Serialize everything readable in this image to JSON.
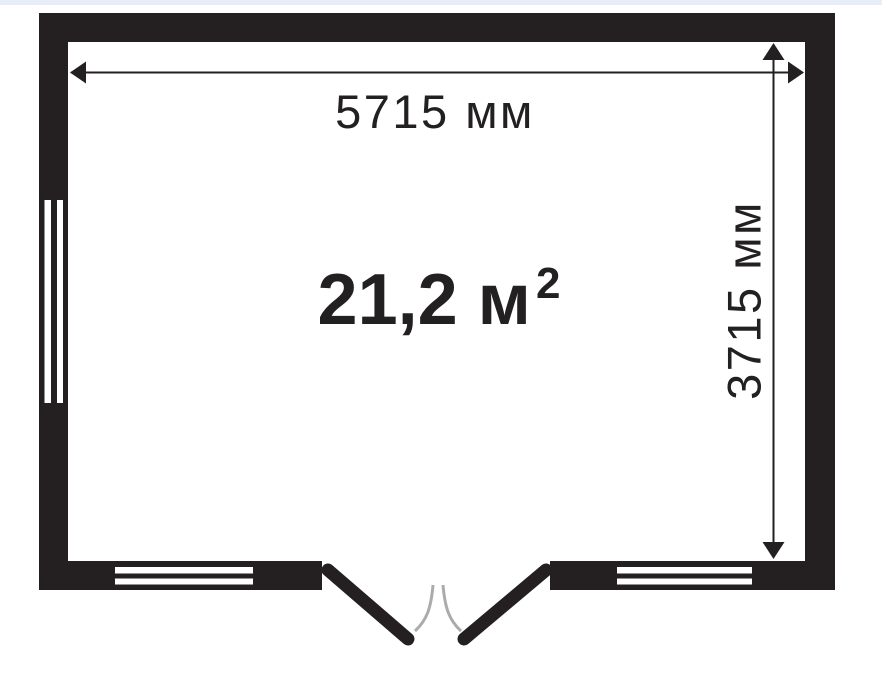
{
  "colors": {
    "bg": "#ffffff",
    "banner": "#e8eef7",
    "ink": "#232021",
    "wall": "#242021",
    "arc": "#ababab"
  },
  "floorplan": {
    "width_label": "5715 мм",
    "height_label": "3715 мм",
    "area_label": "21,2 м",
    "area_exponent": "2"
  }
}
